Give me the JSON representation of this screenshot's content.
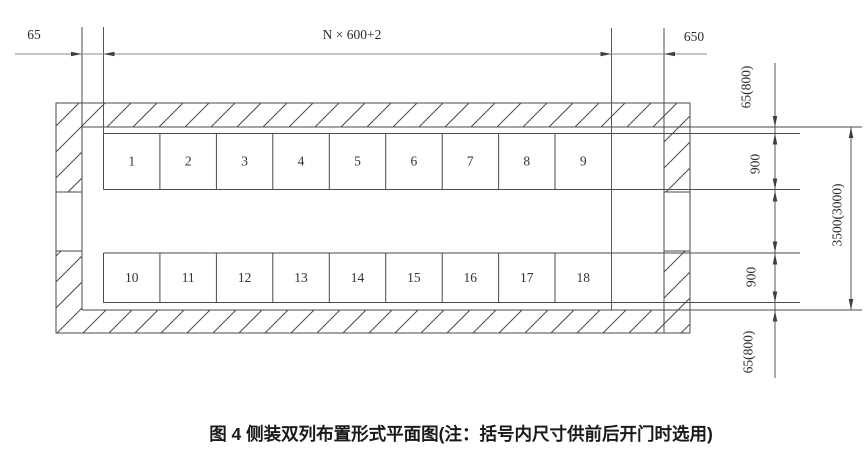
{
  "figure": {
    "caption": "图 4  侧装双列布置形式平面图(注：括号内尺寸供前后开门时选用)",
    "dimensions": {
      "top_left_wall_gap": "65",
      "top_row_width": "N × 600+2",
      "top_right_aisle": "650",
      "right_top_wall_gap": "65(800)",
      "right_top_row_depth": "900",
      "right_bottom_row_depth": "900",
      "right_bottom_wall_gap": "65(800)",
      "right_overall_width": "3500(3000)"
    },
    "top_row_cells": [
      "1",
      "2",
      "3",
      "4",
      "5",
      "6",
      "7",
      "8",
      "9"
    ],
    "bottom_row_cells": [
      "10",
      "11",
      "12",
      "13",
      "14",
      "15",
      "16",
      "17",
      "18"
    ],
    "colors": {
      "drawing_line": "#4a4a4a",
      "dimension_line": "#8a8a8a",
      "text": "#2b2b2b",
      "background": "#ffffff"
    }
  }
}
